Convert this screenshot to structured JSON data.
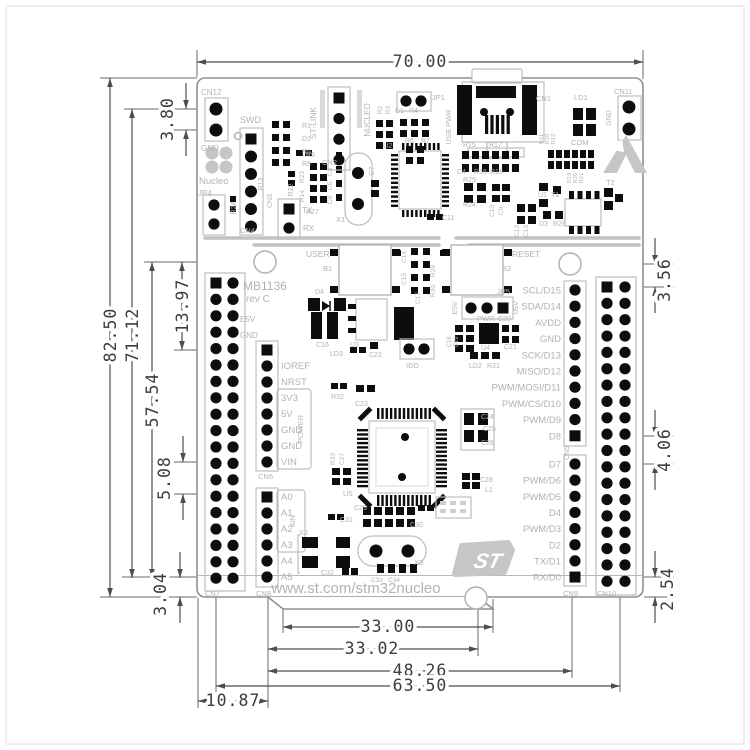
{
  "page": {
    "background": "#ffffff",
    "border_color": "#dcdcdc"
  },
  "drawing": {
    "type": "board-mechanical-drawing",
    "units": "mm"
  },
  "dims": {
    "width": "70.00",
    "height": "82.50",
    "h_pins": "71.12",
    "h_inner": "57.54",
    "h_hole": "13.97",
    "h_gap": "5.08",
    "h_bottom": "3.04",
    "h_top": "3.80",
    "r_top": "3.56",
    "r_mid": "4.06",
    "r_bottom": "2.54",
    "b_tab": "33.00",
    "b_tab2": "33.02",
    "b_wide": "48.26",
    "b_full": "63.50",
    "b_left": "10.87"
  },
  "branding": {
    "nucleo": "Nucleo",
    "board_name": "MB1136",
    "board_rev": "rev C",
    "url": "www.st.com/stm32nucleo",
    "logo": "ST"
  },
  "pins": {
    "power": [
      "IOREF",
      "NRST",
      "3V3",
      "5V",
      "GND",
      "GND",
      "VIN"
    ],
    "power_group": "POWER",
    "analog": [
      "A0",
      "A1",
      "A2",
      "A3",
      "A4",
      "A5"
    ],
    "analog_group": "AIN",
    "digital_top": [
      "SCL/D15",
      "SDA/D14",
      "AVDD",
      "GND",
      "SCK/D13",
      "MISO/D12",
      "PWM/MOSI/D11",
      "PWM/CS/D10",
      "PWM/D9",
      "D8"
    ],
    "digital_bottom": [
      "D7",
      "PWM/D6",
      "PWM/D5",
      "D4",
      "PWM/D3",
      "D2",
      "TX/D1",
      "RX/D0"
    ]
  },
  "silk": {
    "cn12": "CN12",
    "gnd_cn12": "GND",
    "swd": "SWD",
    "cn4": "CN4",
    "jp4": "JP4",
    "r26": "R26",
    "r13": "R13",
    "cn3": "CN3",
    "tx": "TX",
    "rx": "RX",
    "r1": "R1",
    "d1": "D1",
    "r5": "R5",
    "r8": "R8",
    "r9": "R9",
    "r22": "R22",
    "r23": "R23",
    "r14": "R14",
    "r27": "R27",
    "c3": "C3",
    "c6": "C6",
    "c8": "C8",
    "stlink": "ST-LINK",
    "cn2": "CN2",
    "nucleo_vert": "NUCLEO",
    "r2": "R2",
    "r3": "R3",
    "c1": "C1",
    "r4": "R4",
    "r6": "R6",
    "r7": "R7",
    "jp1": "JP1",
    "usb_pwr": "USB PWR",
    "cn1": "CN1",
    "ld1": "LD1",
    "cn11": "CN11",
    "gnd_cn11": "GND",
    "com": "COM",
    "r10": "R10",
    "r11": "R11",
    "r12": "R12",
    "u2": "U2",
    "c7": "C7",
    "c11": "C11",
    "x1": "X1",
    "r15": "R15",
    "r17": "R17",
    "c4": "C4",
    "r16": "R16",
    "r18": "R18",
    "r25": "R25",
    "r24": "R24",
    "c9": "C9",
    "c10": "C10",
    "c12": "C12",
    "c13": "C13",
    "u1": "U1",
    "t1": "T1",
    "t2": "T2",
    "r19": "R19",
    "r20": "R20",
    "r21": "R21",
    "d3": "D3",
    "r28": "R28",
    "user": "USER",
    "b1": "B1",
    "reset": "RESET",
    "b2": "B2",
    "c14": "C14",
    "c15": "C15",
    "r29": "R29",
    "r30": "R30",
    "c17": "C17",
    "d4": "D4",
    "c16": "C16",
    "u3": "U3",
    "ld3": "LD3",
    "c22": "C22",
    "idd": "IDD",
    "jp5": "JP5",
    "e5v_jp": "E5V",
    "u5v": "U5V",
    "pwr": "PWR",
    "c20": "C20",
    "u4": "U4",
    "c21": "C21",
    "c18": "C18",
    "c19": "C19",
    "ld2": "LD2",
    "r31": "R31",
    "e5v": "E5V",
    "gnd_left": "GND",
    "cn5": "CN5",
    "cn6": "CN6",
    "cn7": "CN7",
    "cn8": "CN8",
    "cn9": "CN9",
    "cn10": "CN10",
    "u5": "U5",
    "r32": "R32",
    "c23": "C23",
    "r33": "R33",
    "c27": "C27",
    "c24": "C24",
    "c25": "C25",
    "c26": "C26",
    "c28": "C28",
    "l1": "L1",
    "c29": "C29",
    "c30": "C30",
    "c31": "C31",
    "x2": "X2",
    "c32": "C32",
    "x3": "X3",
    "c33": "C33",
    "c34": "C34"
  }
}
